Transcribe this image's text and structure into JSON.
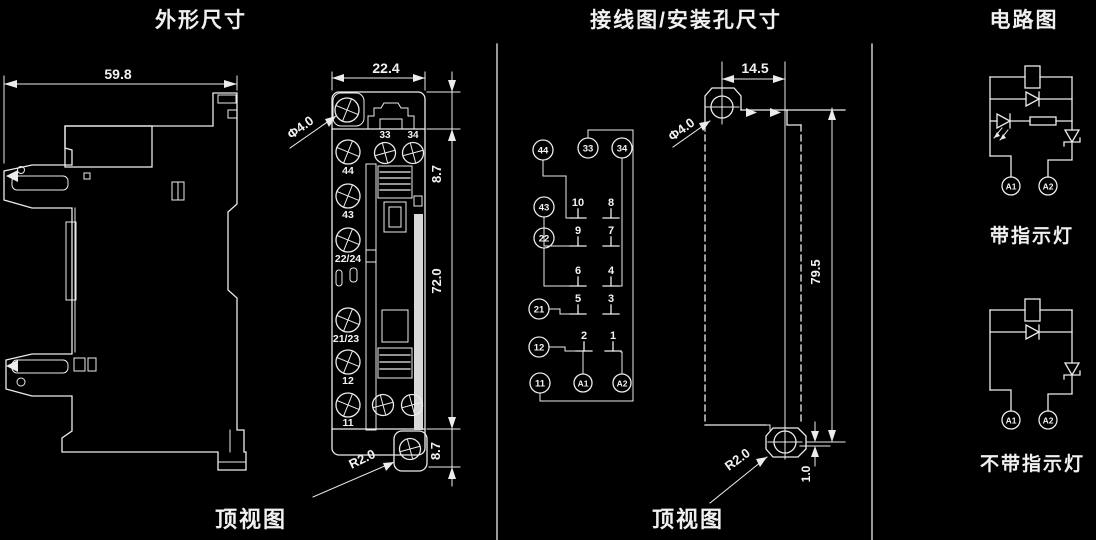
{
  "titles": {
    "outline": "外形尺寸",
    "wiring": "接线图/安装孔尺寸",
    "circuit": "电路图"
  },
  "captions": {
    "outline": "顶视图",
    "wiring": "顶视图"
  },
  "side_view": {
    "width": "59.8"
  },
  "top_view": {
    "width": "22.4",
    "h_top": "8.7",
    "h_body": "72.0",
    "h_bottom": "8.7",
    "hole": "Φ4.0",
    "radius": "R2.0",
    "labels_top": [
      "33",
      "34"
    ],
    "labels_left": [
      "44",
      "43",
      "22/24",
      "21/23",
      "12",
      "11"
    ]
  },
  "wiring": {
    "terminals": [
      "44",
      "33",
      "34",
      "43",
      "22",
      "21",
      "12",
      "11"
    ],
    "coil_terminals": [
      "A1",
      "A2"
    ],
    "pins": [
      "10",
      "8",
      "9",
      "7",
      "6",
      "4",
      "5",
      "3",
      "2",
      "1"
    ],
    "mount": {
      "hole": "Φ4.0",
      "pitch_x": "14.5",
      "pitch_y": "79.5",
      "offset": "1.0",
      "radius": "R2.0"
    }
  },
  "circuits": {
    "with_led": "带指示灯",
    "without_led": "不带指示灯",
    "terminal_a1": "A1",
    "terminal_a2": "A2"
  }
}
